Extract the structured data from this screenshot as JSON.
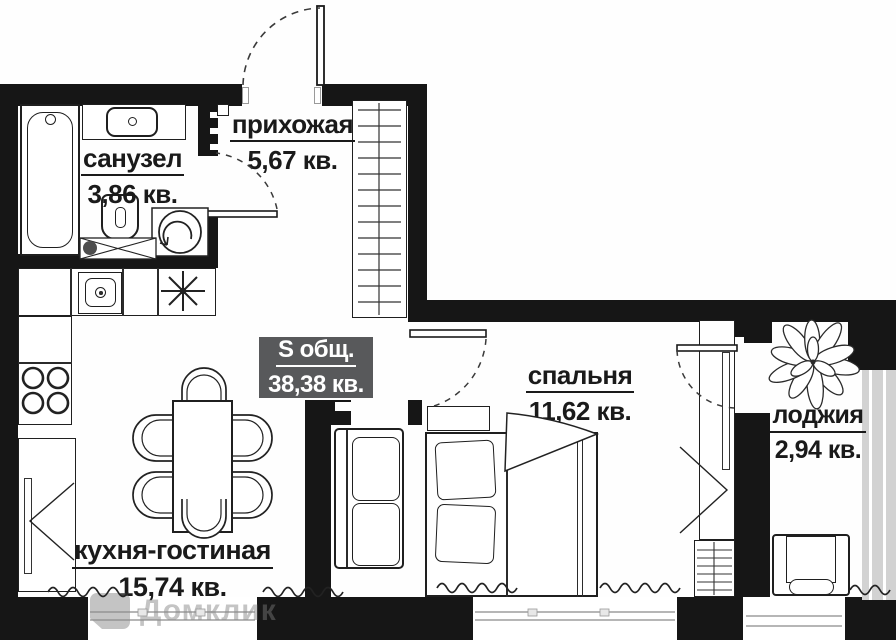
{
  "plan": {
    "total": {
      "label": "S общ.",
      "area": "38,38 кв."
    },
    "rooms": [
      {
        "id": "bathroom",
        "name": "санузел",
        "area": "3,86 кв."
      },
      {
        "id": "hallway",
        "name": "прихожая",
        "area": "5,67 кв."
      },
      {
        "id": "kitchen_living",
        "name": "кухня-гостиная",
        "area": "15,74 кв."
      },
      {
        "id": "bedroom",
        "name": "спальня",
        "area": "11,62 кв."
      },
      {
        "id": "loggia",
        "name": "лоджия",
        "area": "2,94 кв."
      }
    ],
    "watermark": "Домклик",
    "colors": {
      "wall": "#161616",
      "highlight_box": "#58595b",
      "background": "#ffffff"
    }
  }
}
